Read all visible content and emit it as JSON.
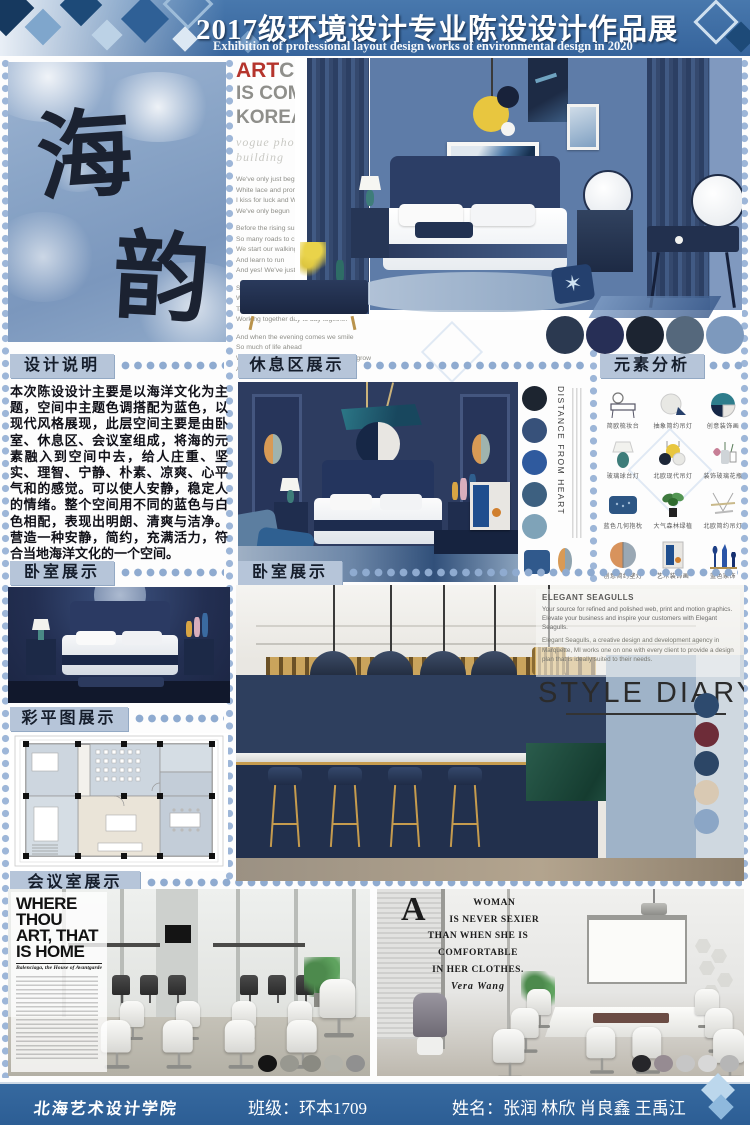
{
  "header": {
    "title": "2017级环境设计专业陈设设计作品展",
    "subtitle": "Exhibition of professional layout design works of environmental design in 2020"
  },
  "calligraphy": {
    "char_top": "海",
    "char_bottom": "韵"
  },
  "art_city": {
    "word_red": "ART",
    "word_gray": "CITY",
    "line2": "IS COMMING TO",
    "line3": "KOREA",
    "tagline": "vogue photography building",
    "stanza1": "We've only just begun to live\nWhite lace and promises\nI kiss for luck and We're on our way\nWe've only begun",
    "stanza2": "Before the rising sun we fly\nSo many roads to choose\nWe start our walking\nAnd learn to run\nAnd yes! We've just begun",
    "stanza3": "Sharing horizons that are new to us\nWatching the sights along the way\nTalking it over just the two of us\nWorking together day to day together",
    "stanza4": "And when the evening comes we smile\nSo much of life ahead\nWe'll find a place where there's room to grow\nAnd yes! We've just begun"
  },
  "sections": {
    "design_note": {
      "title": "设计说明",
      "body": "本次陈设设计主要是以海洋文化为主题，空间中主题色调搭配为蓝色，以现代风格展现，此层空间主要是由卧室、休息区、会议室组成，将海的元素融入到空间中去，给人庄重、坚实、理智、宁静、朴素、凉爽、心平气和的感觉。可以使人安静，稳定人的情绪。整个空间用不同的蓝色与白色相配，表现出明朗、清爽与洁净。营造一种安静，简约，充满活力，符合当地海洋文化的一个空间。"
    },
    "rest_area": {
      "title": "休息区展示",
      "vertical_caption": "DISTANCE FROM HEART"
    },
    "element_analysis": {
      "title": "元素分析",
      "items": [
        {
          "label": "简欧梳妆台"
        },
        {
          "label": "抽象简约吊灯"
        },
        {
          "label": "创意装饰画"
        },
        {
          "label": "玻璃球台灯"
        },
        {
          "label": "北欧现代吊灯"
        },
        {
          "label": "装饰玻璃花瓶"
        },
        {
          "label": "蓝色几何抱枕"
        },
        {
          "label": "大气森林绿植"
        },
        {
          "label": "北欧简约吊灯"
        },
        {
          "label": "创意简约壁灯"
        },
        {
          "label": "艺术装饰画"
        },
        {
          "label": "蓝色家饰"
        }
      ]
    },
    "bedroom_left": {
      "title": "卧室展示"
    },
    "bedroom_main": {
      "title": "卧室展示"
    },
    "color_plan": {
      "title": "彩平图展示"
    },
    "meeting_room": {
      "title": "会议室展示"
    }
  },
  "style_diary": {
    "heading": "ELEGANT SEAGULLS",
    "para1": "Your source for refined and polished web, print and motion graphics. Elevate your business and inspire your customers with Elegant Seagulls.",
    "para2": "Elegant Seagulls, a creative design and development agency in Marquette, MI works one on one with every client to provide a design plan that is ideally suited to their needs.",
    "big_text": "STYLE DIARY"
  },
  "where_thou": {
    "title": "WHERE\nTHOU\nART, THAT\nIS HOME",
    "subtitle": "Balenciaga, the House of Avantgarde"
  },
  "quote": {
    "initial": "A",
    "text": "WOMAN\nIS NEVER SEXIER\nTHAN WHEN SHE IS\nCOMFORTABLE\nIN HER CLOTHES.",
    "author": "Vera Wang"
  },
  "decor": {
    "starfish_glyph": "✶"
  },
  "palettes": {
    "bedroom_top": [
      "#2b3950",
      "#272f56",
      "#1c2431",
      "#55687c",
      "#7d99bd"
    ],
    "rest_area": [
      "#1d2530",
      "#37517a",
      "#2f5a9e",
      "#3d6080",
      "#7fa3b8"
    ],
    "style_diary": [
      "#2d4a6e",
      "#6d2c38",
      "#2c4666",
      "#d9c9b3",
      "#8ba6c6"
    ],
    "conference_left": [
      "#151515",
      "#989890",
      "#8a8a82",
      "#b3b3ab",
      "#909090"
    ],
    "conference_right": [
      "#26262a",
      "#968b92",
      "#c6c6c6",
      "#d8d8d8",
      "#b6b6b6"
    ]
  },
  "footer": {
    "school": "北海艺术设计学院",
    "class_label": "班级：环本1709",
    "names_label": "姓名：张润 林欣 肖良鑫 王禹江"
  }
}
